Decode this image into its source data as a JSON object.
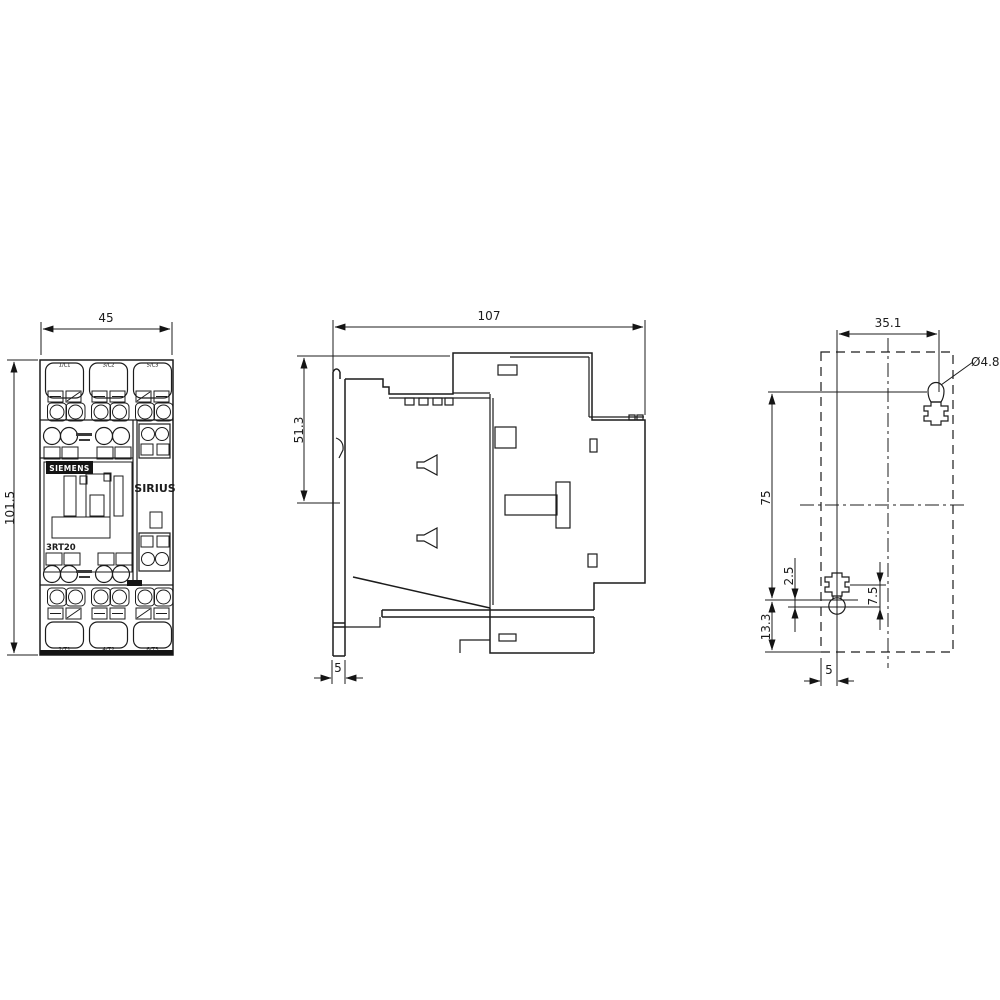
{
  "front_view": {
    "width": "45",
    "height": "101.5",
    "brand": "SIEMENS",
    "series": "SIRIUS",
    "model": "3RT20",
    "top_terminal_labels": [
      "1/L1",
      "3/L2",
      "5/L3"
    ],
    "bottom_terminal_labels": [
      "2/T1",
      "4/T2",
      "6/T3"
    ]
  },
  "side_view": {
    "depth": "107",
    "upper_section_height": "51.3",
    "rail_clip_depth": "5"
  },
  "drilling_plan": {
    "horizontal_hole_spacing": "35.1",
    "hole_diameter": "Ø4.8",
    "vertical_hole_spacing": "75",
    "center_offset": "2.5",
    "bottom_edge_offset": "13.3",
    "slot_length": "7.5",
    "edge_offset": "5"
  }
}
